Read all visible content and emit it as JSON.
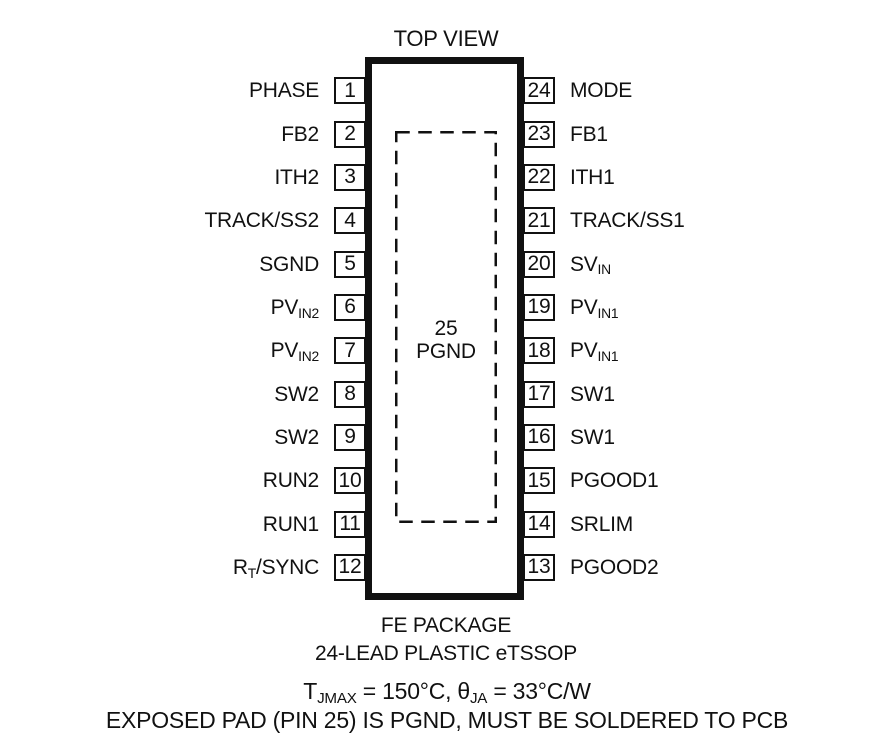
{
  "title": "TOP VIEW",
  "package": {
    "left_pins": [
      {
        "num": "1",
        "parts": [
          {
            "t": "PHASE"
          }
        ]
      },
      {
        "num": "2",
        "parts": [
          {
            "t": "FB2"
          }
        ]
      },
      {
        "num": "3",
        "parts": [
          {
            "t": "ITH2"
          }
        ]
      },
      {
        "num": "4",
        "parts": [
          {
            "t": "TRACK/SS2"
          }
        ]
      },
      {
        "num": "5",
        "parts": [
          {
            "t": "SGND"
          }
        ]
      },
      {
        "num": "6",
        "parts": [
          {
            "t": "PV"
          },
          {
            "t": "IN2",
            "sub": true
          }
        ]
      },
      {
        "num": "7",
        "parts": [
          {
            "t": "PV"
          },
          {
            "t": "IN2",
            "sub": true
          }
        ]
      },
      {
        "num": "8",
        "parts": [
          {
            "t": "SW2"
          }
        ]
      },
      {
        "num": "9",
        "parts": [
          {
            "t": "SW2"
          }
        ]
      },
      {
        "num": "10",
        "parts": [
          {
            "t": "RUN2"
          }
        ]
      },
      {
        "num": "11",
        "parts": [
          {
            "t": "RUN1"
          }
        ]
      },
      {
        "num": "12",
        "parts": [
          {
            "t": "R"
          },
          {
            "t": "T",
            "sub": true
          },
          {
            "t": "/SYNC"
          }
        ]
      }
    ],
    "right_pins": [
      {
        "num": "24",
        "parts": [
          {
            "t": "MODE"
          }
        ]
      },
      {
        "num": "23",
        "parts": [
          {
            "t": "FB1"
          }
        ]
      },
      {
        "num": "22",
        "parts": [
          {
            "t": "ITH1"
          }
        ]
      },
      {
        "num": "21",
        "parts": [
          {
            "t": "TRACK/SS1"
          }
        ]
      },
      {
        "num": "20",
        "parts": [
          {
            "t": "SV"
          },
          {
            "t": "IN",
            "sub": true
          }
        ]
      },
      {
        "num": "19",
        "parts": [
          {
            "t": "PV"
          },
          {
            "t": "IN1",
            "sub": true
          }
        ]
      },
      {
        "num": "18",
        "parts": [
          {
            "t": "PV"
          },
          {
            "t": "IN1",
            "sub": true
          }
        ]
      },
      {
        "num": "17",
        "parts": [
          {
            "t": "SW1"
          }
        ]
      },
      {
        "num": "16",
        "parts": [
          {
            "t": "SW1"
          }
        ]
      },
      {
        "num": "15",
        "parts": [
          {
            "t": "PGOOD1"
          }
        ]
      },
      {
        "num": "14",
        "parts": [
          {
            "t": "SRLIM"
          }
        ]
      },
      {
        "num": "13",
        "parts": [
          {
            "t": "PGOOD2"
          }
        ]
      }
    ],
    "exposed_pad": {
      "num": "25",
      "label": "PGND"
    }
  },
  "captions": {
    "package_name": "FE PACKAGE",
    "package_type": "24-LEAD PLASTIC eTSSOP"
  },
  "notes": {
    "thermal": [
      {
        "t": "T"
      },
      {
        "t": "JMAX",
        "sub": true
      },
      {
        "t": " = 150°C, "
      },
      {
        "t": "θ"
      },
      {
        "t": "JA",
        "sub": true
      },
      {
        "t": " = 33°C/W"
      }
    ],
    "exposed_pad_note": "EXPOSED PAD (PIN 25) IS PGND, MUST BE SOLDERED TO PCB"
  },
  "colors": {
    "ink": "#111111",
    "background": "#ffffff"
  }
}
